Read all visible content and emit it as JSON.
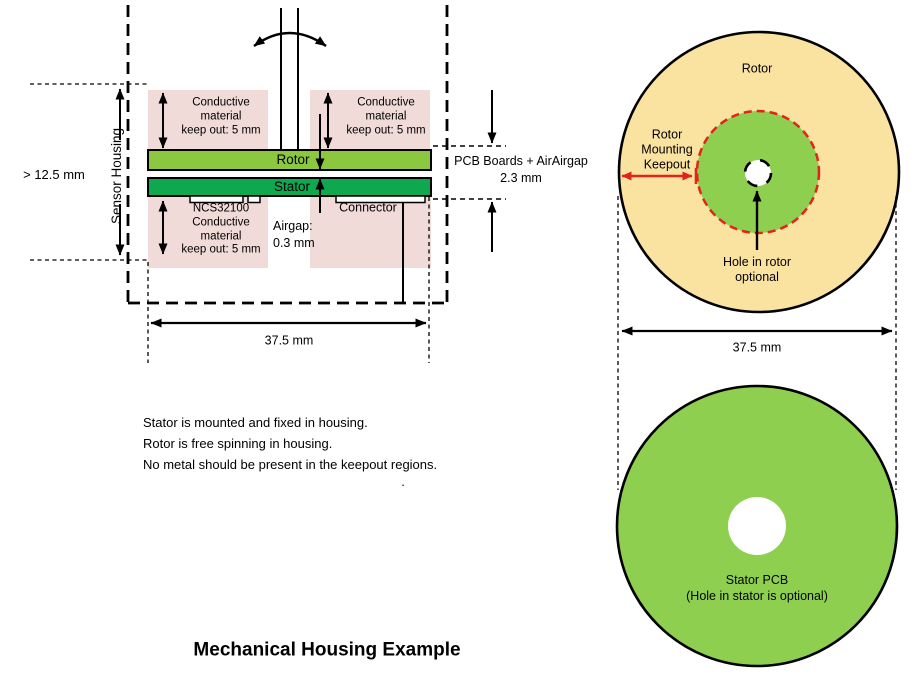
{
  "title": "Mechanical Housing Example",
  "colors": {
    "keepout_pink": "#F0DBD8",
    "rotor_pcb_green": "#8CC83F",
    "stator_pcb_green": "#0FA84F",
    "disc_green": "#8ECF50",
    "rotor_yellow": "#FAE3A0",
    "red": "#E2231A",
    "line_black": "#000000"
  },
  "cross_section": {
    "sensor_housing_label": "Sensor Housing",
    "height_dimension": "> 12.5 mm",
    "keepout_top_left": "Conductive\nmaterial\nkeep out: 5 mm",
    "keepout_top_right": "Conductive\nmaterial\nkeep out: 5 mm",
    "keepout_bottom_left": "NCS32100\nConductive\nmaterial\nkeep out: 5 mm",
    "rotor_label": "Rotor",
    "stator_label": "Stator",
    "connector_label": "Connector",
    "airgap_label": "Airgap:\n0.3 mm",
    "pcb_callout": "PCB Boards + AirAirgap\n2.3 mm",
    "width_dimension": "37.5 mm"
  },
  "notes_text": "Stator is mounted and fixed in housing.\nRotor is free spinning in housing.\nNo metal should be present in the keepout regions.",
  "stray_period": ".",
  "rotor_top_view": {
    "rotor_label": "Rotor",
    "mounting_keepout_label": "Rotor\nMounting\nKeepout",
    "hole_label": "Hole in rotor\noptional",
    "width_dimension": "37.5 mm"
  },
  "stator_top_view": {
    "label": "Stator PCB\n(Hole in stator is optional)"
  }
}
